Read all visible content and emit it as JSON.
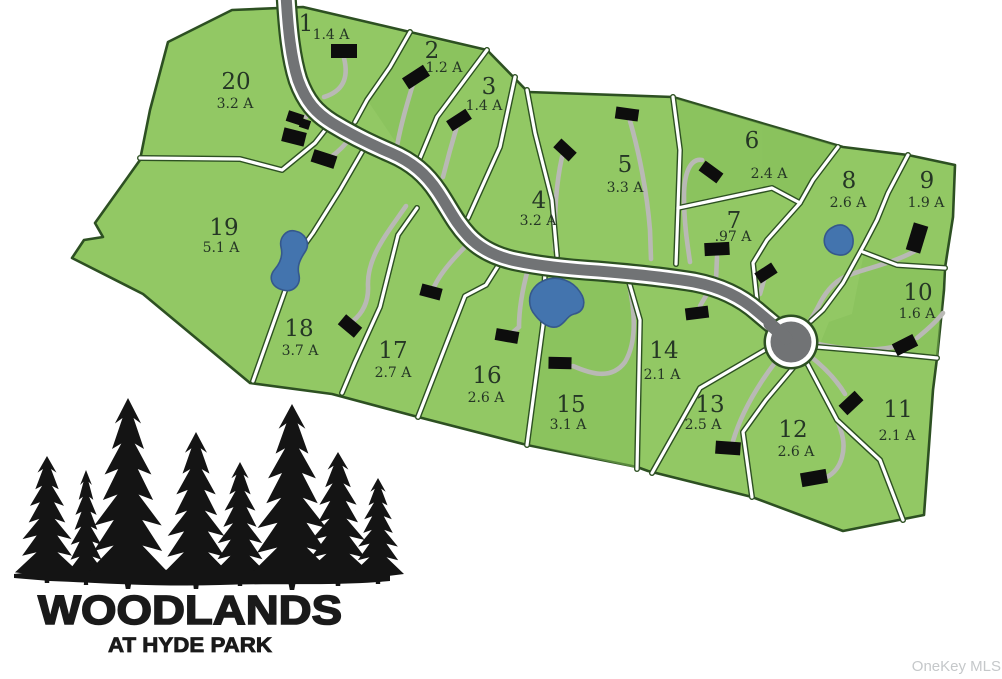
{
  "title": "Woodlands at Hyde Park plat map",
  "logo": {
    "name": "WOODLANDS",
    "tagline": "AT HYDE PARK"
  },
  "watermark": "OneKey MLS",
  "colors": {
    "lot_green": "#92c864",
    "lot_green_dark": "#86bd5a",
    "boundary_green": "#2d5022",
    "road_gray": "#717375",
    "driveway_gray": "#b9b9b5",
    "pond_blue": "#4374ae",
    "house_black": "#0d0d0d",
    "label_ink": "#253625",
    "watermark_gray": "#c5c8ca"
  },
  "lots": [
    {
      "number": "1",
      "area": "1.4 A"
    },
    {
      "number": "2",
      "area": "1.2 A"
    },
    {
      "number": "3",
      "area": "1.4 A"
    },
    {
      "number": "4",
      "area": "3.2 A"
    },
    {
      "number": "5",
      "area": "3.3 A"
    },
    {
      "number": "6",
      "area": "2.4 A"
    },
    {
      "number": "7",
      "area": ".97 A"
    },
    {
      "number": "8",
      "area": "2.6 A"
    },
    {
      "number": "9",
      "area": "1.9 A"
    },
    {
      "number": "10",
      "area": "1.6 A"
    },
    {
      "number": "11",
      "area": "2.1 A"
    },
    {
      "number": "12",
      "area": "2.6 A"
    },
    {
      "number": "13",
      "area": "2.5 A"
    },
    {
      "number": "14",
      "area": "2.1 A"
    },
    {
      "number": "15",
      "area": "3.1 A"
    },
    {
      "number": "16",
      "area": "2.6 A"
    },
    {
      "number": "17",
      "area": "2.7 A"
    },
    {
      "number": "18",
      "area": "3.7 A"
    },
    {
      "number": "19",
      "area": "5.1 A"
    },
    {
      "number": "20",
      "area": "3.2 A"
    }
  ]
}
